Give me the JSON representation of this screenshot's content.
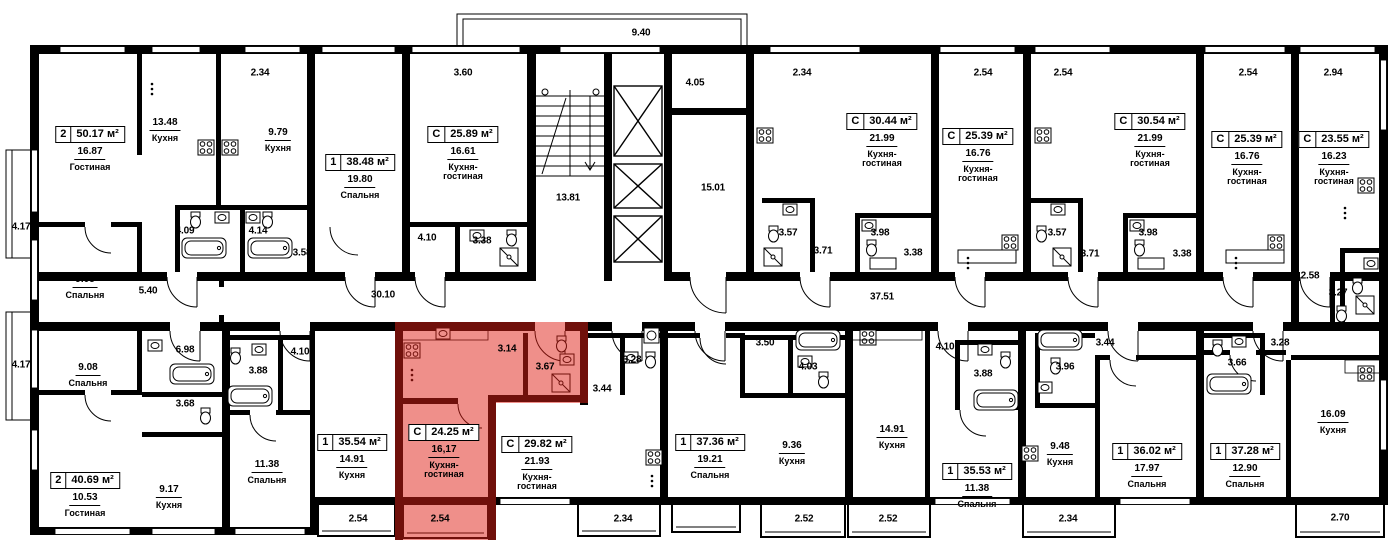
{
  "colors": {
    "wall": "#000000",
    "background": "#ffffff",
    "highlight_fill": "rgba(224,32,22,0.5)",
    "highlight_wall_appearance": "#7b1b16"
  },
  "apartments": [
    {
      "type": "2",
      "area": "50.17 м²",
      "room_area": "16.87",
      "room_name": "Гостиная",
      "highlighted": false
    },
    {
      "type": "1",
      "area": "38.48 м²",
      "room_area": "19.80",
      "room_name": "Спальня",
      "highlighted": false
    },
    {
      "type": "С",
      "area": "25.89 м²",
      "room_area": "16.61",
      "room_name": "Кухня-\nгостиная",
      "highlighted": false
    },
    {
      "type": "С",
      "area": "30.44 м²",
      "room_area": "21.99",
      "room_name": "Кухня-\nгостиная",
      "highlighted": false
    },
    {
      "type": "С",
      "area": "25.39 м²",
      "room_area": "16.76",
      "room_name": "Кухня-\nгостиная",
      "highlighted": false
    },
    {
      "type": "С",
      "area": "30.54 м²",
      "room_area": "21.99",
      "room_name": "Кухня-\nгостиная",
      "highlighted": false
    },
    {
      "type": "С",
      "area": "25.39 м²",
      "room_area": "16.76",
      "room_name": "Кухня-\nгостиная",
      "highlighted": false
    },
    {
      "type": "С",
      "area": "23.55 м²",
      "room_area": "16.23",
      "room_name": "Кухня-\nгостиная",
      "highlighted": false
    },
    {
      "type": "2",
      "area": "40.69 м²",
      "room_area": "10.53",
      "room_name": "Гостиная",
      "highlighted": false
    },
    {
      "type": "1",
      "area": "35.54 м²",
      "room_area": "14.91",
      "room_name": "Кухня",
      "highlighted": false
    },
    {
      "type": "С",
      "area": "24.25 м²",
      "room_area": "16,17",
      "room_name": "Кухня-\nгостиная",
      "highlighted": true
    },
    {
      "type": "С",
      "area": "29.82 м²",
      "room_area": "21.93",
      "room_name": "Кухня-\nгостиная",
      "highlighted": false
    },
    {
      "type": "1",
      "area": "37.36 м²",
      "room_area": "19.21",
      "room_name": "Спальня",
      "highlighted": false
    },
    {
      "type": "1",
      "area": "35.53 м²",
      "room_area": "11.38",
      "room_name": "Спальня",
      "highlighted": false
    },
    {
      "type": "1",
      "area": "36.02 м²",
      "room_area": "17.97",
      "room_name": "Спальня",
      "highlighted": false
    },
    {
      "type": "1",
      "area": "37.28 м²",
      "room_area": "12.90",
      "room_name": "Спальня",
      "highlighted": false
    }
  ],
  "rooms": [
    {
      "area": "13.48",
      "name": "Кухня"
    },
    {
      "area": "9.79",
      "name": "Кухня"
    },
    {
      "area": "9.08",
      "name": "Спальня"
    },
    {
      "area": "9.08",
      "name": "Спальня"
    },
    {
      "area": "9.17",
      "name": "Кухня"
    },
    {
      "area": "11.38",
      "name": "Спальня"
    },
    {
      "area": "9.36",
      "name": "Кухня"
    },
    {
      "area": "14.91",
      "name": "Кухня"
    },
    {
      "area": "9.48",
      "name": "Кухня"
    },
    {
      "area": "16.09",
      "name": "Кухня"
    }
  ],
  "dims": [
    "2.34",
    "3.60",
    "9.40",
    "2.34",
    "2.54",
    "2.54",
    "2.54",
    "2.94",
    "4.17",
    "4.17",
    "4.09",
    "4.14",
    "3.58",
    "5.40",
    "4.10",
    "3.38",
    "13.81",
    "4.05",
    "15.01",
    "3.57",
    "3.71",
    "3.98",
    "3.38",
    "37.51",
    "3.57",
    "3.71",
    "3.98",
    "3.38",
    "2.58",
    "3.27",
    "30.10",
    "6.98",
    "3.88",
    "4.10",
    "3.68",
    "3.14",
    "3.67",
    "3.28",
    "3.44",
    "3.50",
    "4.03",
    "4.10",
    "3.88",
    "3.96",
    "3.44",
    "3.66",
    "3.28",
    "2.54",
    "2.54",
    "2.34",
    "2.52",
    "2.52",
    "2.34",
    "2.70"
  ]
}
